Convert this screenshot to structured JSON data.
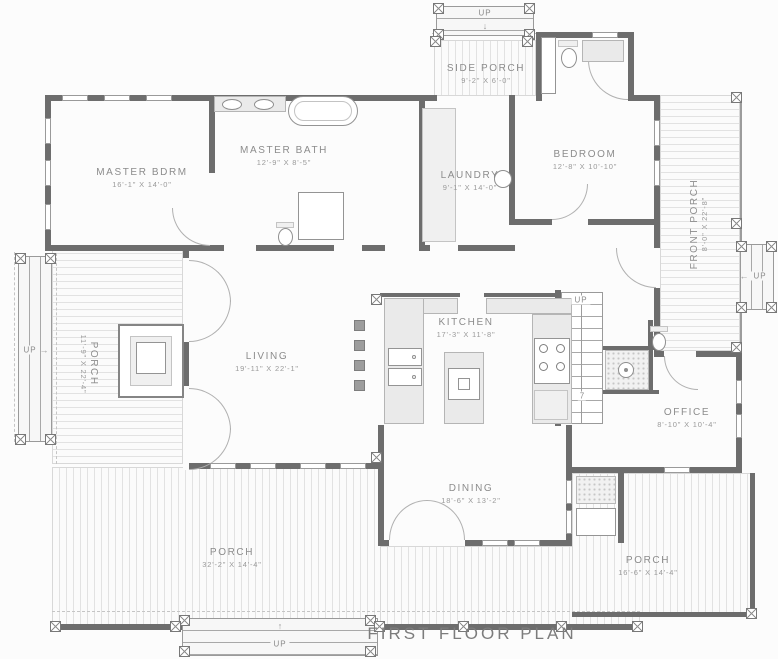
{
  "title": "FIRST FLOOR PLAN",
  "colors": {
    "wall": "#6d6d6d",
    "deck_line": "#e2e2e2",
    "fixture_fill": "#eaeaea",
    "text": "#8c8c8c"
  },
  "rooms": {
    "master_bdrm": {
      "name": "MASTER BDRM",
      "dims": "16'-1\" X 14'-0\""
    },
    "master_bath": {
      "name": "MASTER BATH",
      "dims": "12'-9\" X 8'-5\""
    },
    "laundry": {
      "name": "LAUNDRY",
      "dims": "9'-1\" X 14'-0\""
    },
    "bedroom": {
      "name": "BEDROOM",
      "dims": "12'-8\" X 10'-10\""
    },
    "side_porch": {
      "name": "SIDE PORCH",
      "dims": "9'-2\" X 6'-0\""
    },
    "front_porch": {
      "name": "FRONT PORCH",
      "dims": "8'-0\" X 22'-8\""
    },
    "west_porch": {
      "name": "PORCH",
      "dims": "11'-9\" X 22'-4\""
    },
    "living": {
      "name": "LIVING",
      "dims": "19'-11\" X 22'-1\""
    },
    "kitchen": {
      "name": "KITCHEN",
      "dims": "17'-3\" X 11'-8\""
    },
    "office": {
      "name": "OFFICE",
      "dims": "8'-10\" X 10'-4\""
    },
    "dining": {
      "name": "DINING",
      "dims": "18'-6\" X 13'-2\""
    },
    "south_porch": {
      "name": "PORCH",
      "dims": "32'-2\" X 14'-4\""
    },
    "southeast_porch": {
      "name": "PORCH",
      "dims": "16'-6\" X 14'-4\""
    }
  },
  "stairs": {
    "top": "UP",
    "front": "UP",
    "left": "UP",
    "bottom": "UP",
    "interior": "UP",
    "interior_risers": "7"
  },
  "icons": {
    "arrow_up": "↑",
    "arrow_down": "↓",
    "arrow_left": "←",
    "arrow_right": "→"
  }
}
